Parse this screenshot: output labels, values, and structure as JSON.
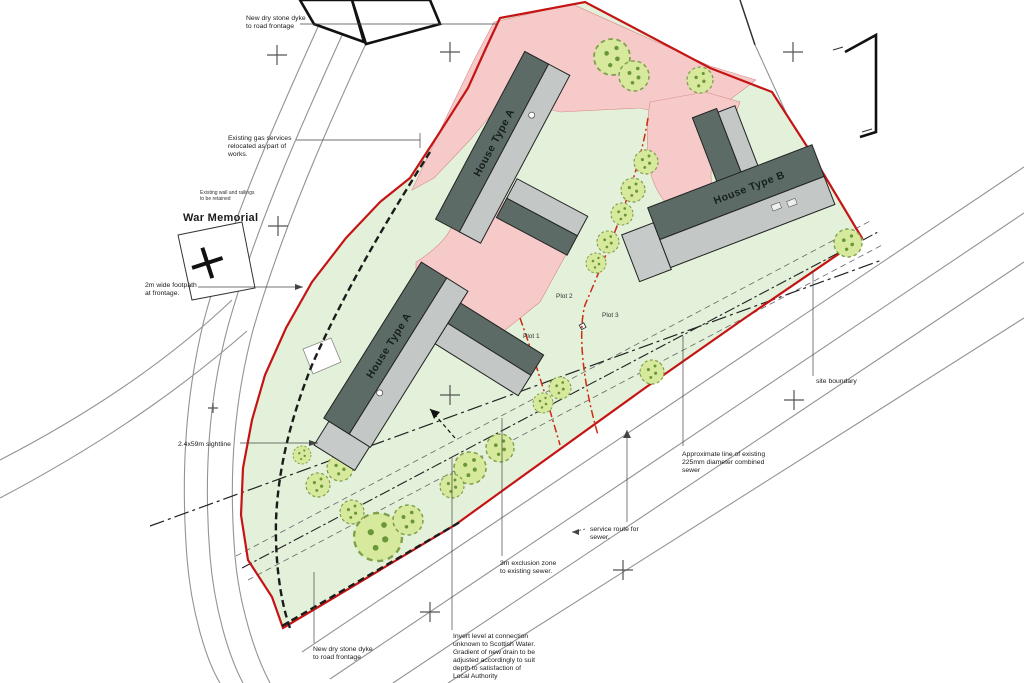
{
  "drawing": {
    "type": "architectural site plan",
    "houses": [
      {
        "id": "house-a-top",
        "label": "House Type A"
      },
      {
        "id": "house-a-lower",
        "label": "House Type A"
      },
      {
        "id": "house-b",
        "label": "House Type B"
      }
    ],
    "plots": [
      {
        "label": "Plot 1"
      },
      {
        "label": "Plot 2"
      },
      {
        "label": "Plot 3"
      }
    ],
    "annotations": {
      "new_dyke_top": {
        "lines": [
          "New dry stone dyke",
          "to road frontage"
        ]
      },
      "gas_services": {
        "lines": [
          "Existing gas services",
          "relocated as part of",
          "works."
        ]
      },
      "memorial_note": {
        "lines": [
          "Existing wall and railings",
          "to be retained"
        ]
      },
      "war_memorial": {
        "lines": [
          "War Memorial"
        ]
      },
      "footpath": {
        "lines": [
          "2m wide footpath",
          "at frontage."
        ]
      },
      "sightline": {
        "lines": [
          "2.4x59m sightline"
        ]
      },
      "site_boundary": {
        "lines": [
          "site boundary"
        ]
      },
      "sewer": {
        "lines": [
          "Approximate line of existing",
          "225mm diameter combined",
          "sewer"
        ]
      },
      "service_route": {
        "lines": [
          "service route for",
          "sewer."
        ]
      },
      "exclusion_zone": {
        "lines": [
          "3m exclusion zone",
          "to existing sewer."
        ]
      },
      "invert_note": {
        "lines": [
          "Invert level at connection",
          "unknown to Scottish Water.",
          "Gradient of new drain to be",
          "adjusted accordingly to suit",
          "depth to satisfaction of",
          "Local Authority"
        ]
      },
      "new_dyke_bottom": {
        "lines": [
          "New dry stone dyke",
          "to road frontage"
        ]
      }
    },
    "colors": {
      "site_green": "#e4f1da",
      "driveway_pink": "#f7caca",
      "boundary_red": "#c41414",
      "plot_line_red": "#cc2b12",
      "roof_dark": "#5d6b66",
      "roof_light": "#c3c8c6",
      "tree_green": "#d6e99c",
      "road_gray": "#8f9494",
      "text": "#1a1a1a"
    }
  }
}
